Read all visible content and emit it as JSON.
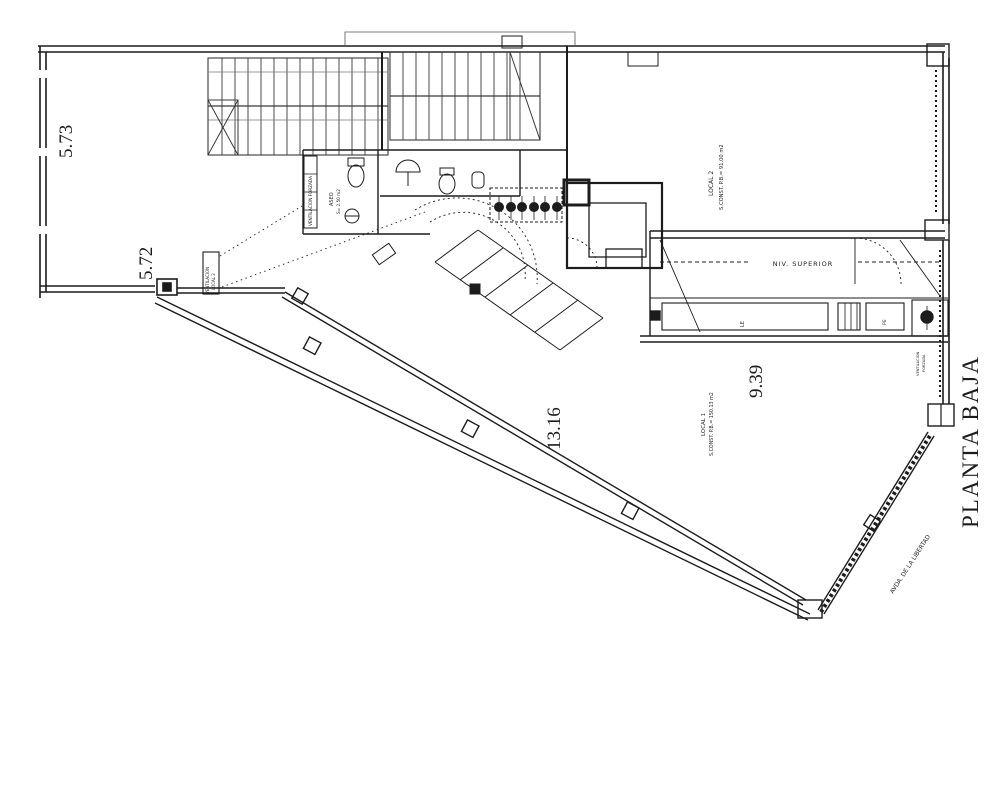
{
  "document": {
    "type": "architectural floor plan",
    "sheet_background": "#ffffff",
    "ink_color": "#1c1c1c"
  },
  "title": "PLANTA BAJA",
  "dims": {
    "left_top": "5.73",
    "left_bottom": "5.72",
    "diagonal": "13.16",
    "right_bottom": "9.39"
  },
  "rooms": {
    "local2": {
      "name": "LOCAL 2",
      "area": "S.CONST. P.B.= 91.00 m2"
    },
    "local1": {
      "name": "LOCAL 1",
      "area": "S.CONST. P.B.= 150.13 m2"
    },
    "aseo": {
      "name": "ASEO",
      "area": "S= 2.50 m2"
    },
    "room_le": "LE",
    "room_pe": "PE"
  },
  "annotations": {
    "niv_superior": "NIV. SUPERIOR",
    "ventilacion_forzada": "VENTILACION FORZADA",
    "vent_line1": "VENTILACION",
    "vent_line2": "FORZADA",
    "vent_local_line1": "VENTILACION",
    "vent_local_line2": "LOCAL 2",
    "street": "AVDA. DE LA LIBERTAD"
  }
}
